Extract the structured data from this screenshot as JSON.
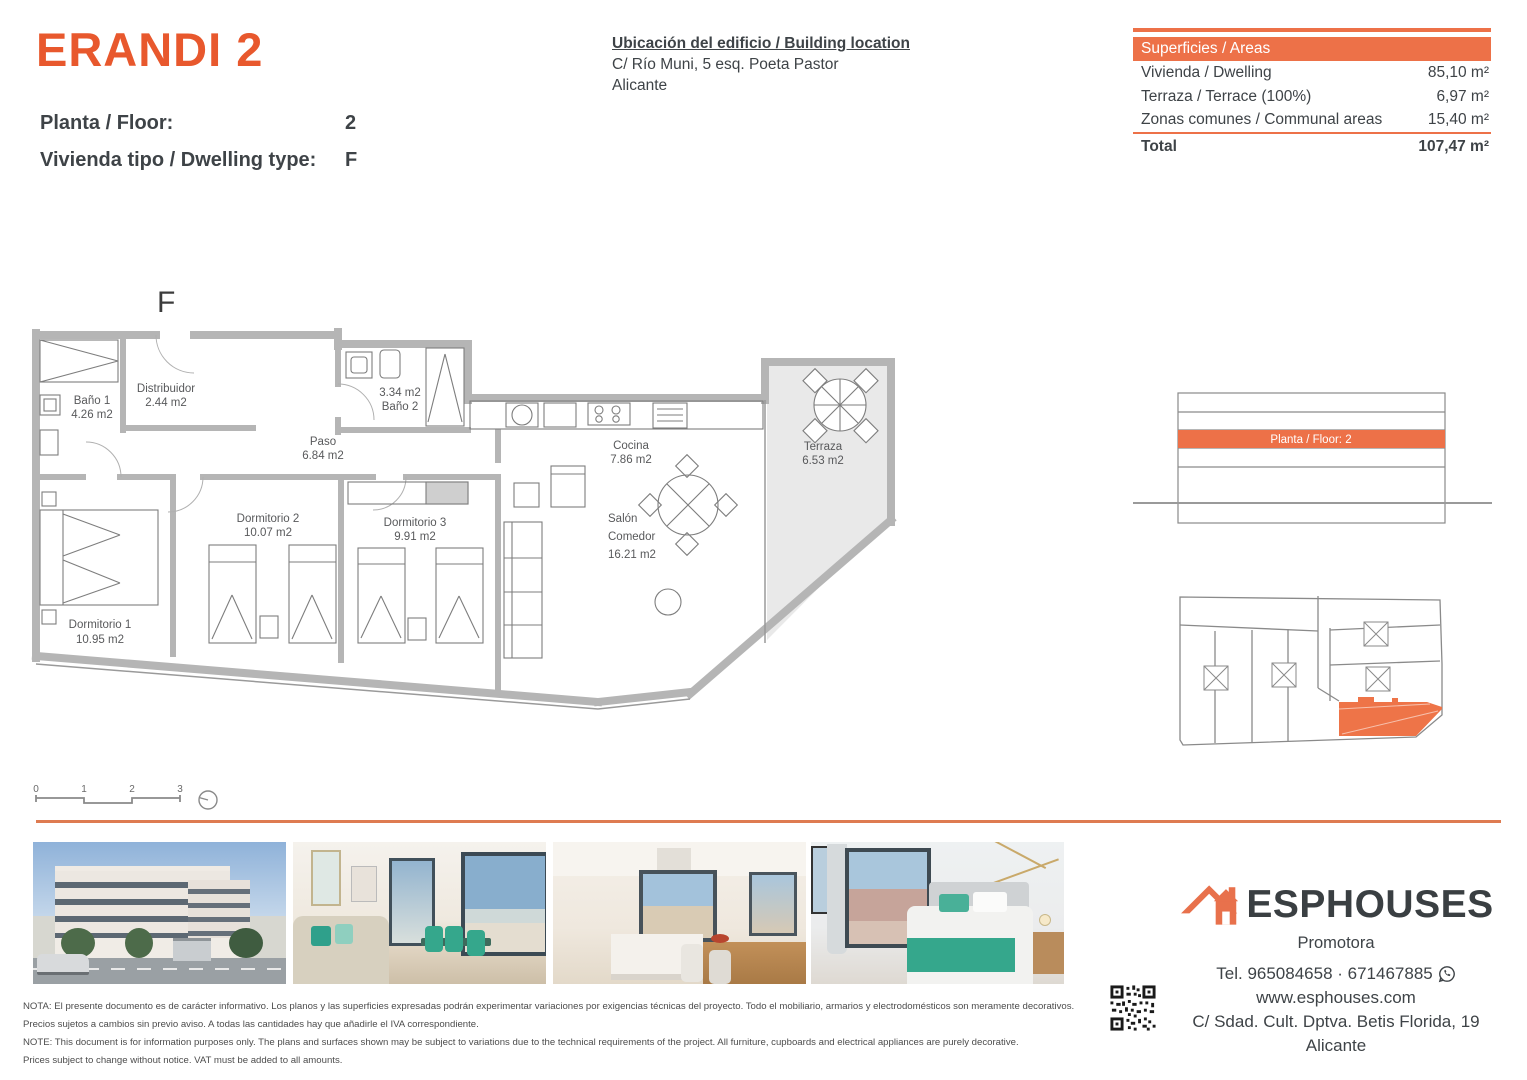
{
  "colors": {
    "title_orange": "#e8582d",
    "band_orange": "#ed7148",
    "divider_orange": "#de7b51",
    "highlight_orange": "#ee7448",
    "wall_gray": "#b5b5b5",
    "text_dark": "#3e4347"
  },
  "header": {
    "title": "ERANDI 2",
    "floor_label": "Planta / Floor:",
    "floor_value": "2",
    "type_label": "Vivienda tipo / Dwelling type:",
    "type_value": "F",
    "location_title": "Ubicación del edificio / Building location",
    "location_line1": "C/ Río Muni, 5 esq. Poeta Pastor",
    "location_line2": "Alicante"
  },
  "areas_table": {
    "header": "Superficies / Areas",
    "rows": [
      {
        "label": "Vivienda / Dwelling",
        "value": "85,10 m²"
      },
      {
        "label": "Terraza / Terrace (100%)",
        "value": "6,97 m²"
      },
      {
        "label": "Zonas comunes / Communal areas",
        "value": "15,40 m²"
      }
    ],
    "total_label": "Total",
    "total_value": "107,47 m²"
  },
  "floorplan": {
    "letter": "F",
    "rooms": [
      {
        "id": "bano-1",
        "lines": [
          "Baño 1",
          "4.26 m2"
        ]
      },
      {
        "id": "distribuidor",
        "lines": [
          "Distribuidor",
          "2.44 m2"
        ]
      },
      {
        "id": "paso",
        "lines": [
          "Paso",
          "6.84 m2"
        ]
      },
      {
        "id": "bano-2",
        "lines": [
          "3.34 m2",
          "Baño 2"
        ]
      },
      {
        "id": "cocina",
        "lines": [
          "Cocina",
          "7.86 m2"
        ]
      },
      {
        "id": "terraza",
        "lines": [
          "Terraza",
          "6.53 m2"
        ]
      },
      {
        "id": "dormitorio-1",
        "lines": [
          "Dormitorio 1",
          "10.95 m2"
        ]
      },
      {
        "id": "dormitorio-2",
        "lines": [
          "Dormitorio 2",
          "10.07 m2"
        ]
      },
      {
        "id": "dormitorio-3",
        "lines": [
          "Dormitorio 3",
          "9.91 m2"
        ]
      },
      {
        "id": "salon-comedor",
        "lines": [
          "Salón",
          "Comedor",
          "16.21 m2"
        ]
      }
    ],
    "scale_ticks": [
      "0",
      "1",
      "2",
      "3"
    ]
  },
  "elevation": {
    "label": "Planta / Floor: 2"
  },
  "photos": [
    "building-exterior",
    "living-room",
    "kitchen-dining",
    "bedroom"
  ],
  "brand": {
    "name": "ESPHOUSES",
    "subtitle": "Promotora",
    "phone": "Tel. 965084658 · 671467885",
    "website": "www.esphouses.com",
    "address_line1": "C/ Sdad. Cult. Dptva. Betis Florida, 19",
    "address_line2": "Alicante"
  },
  "disclaimer": {
    "es_line1": "NOTA: El presente documento es de carácter informativo. Los planos y las superficies expresadas podrán experimentar variaciones por exigencias técnicas del proyecto. Todo el mobiliario, armarios y electrodomésticos son meramente decorativos.",
    "es_line2": "Precios sujetos a cambios sin previo aviso. A todas las cantidades hay que añadirle el IVA correspondiente.",
    "en_line1": "NOTE: This document is for information purposes only. The plans and surfaces shown may be subject to variations due to the technical requirements of the project. All furniture, cupboards and electrical appliances are purely decorative.",
    "en_line2": "Prices subject to change without notice. VAT must be added to all amounts."
  }
}
